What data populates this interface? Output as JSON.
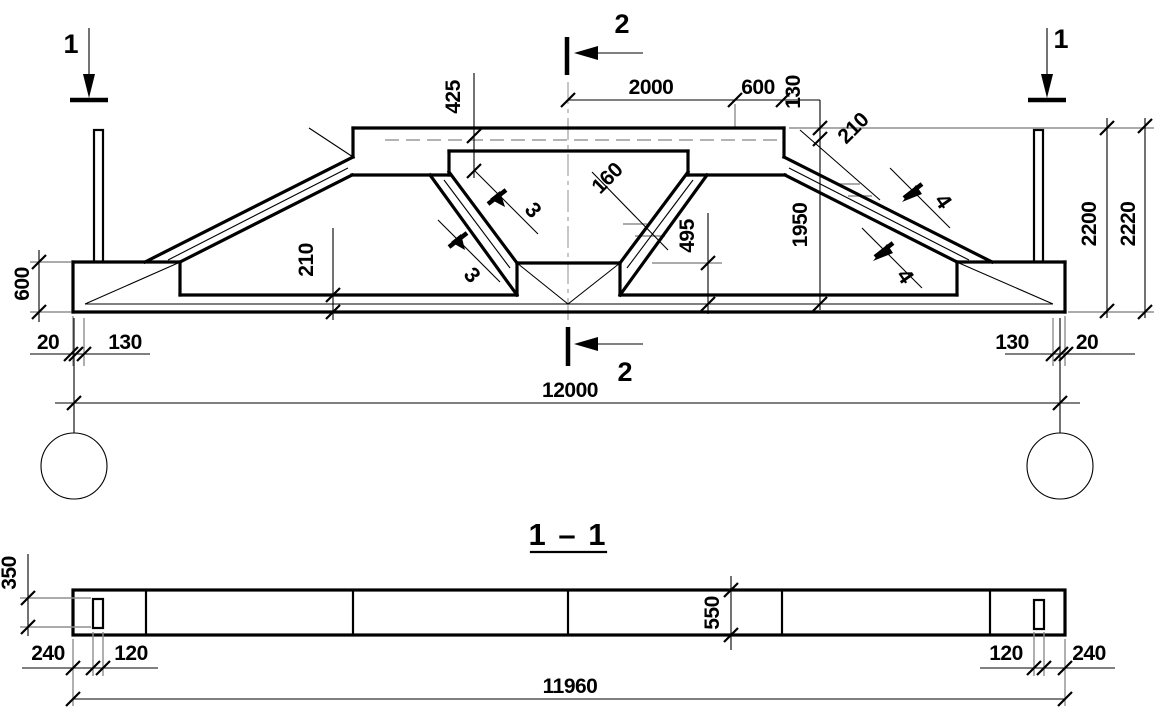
{
  "colors": {
    "ink": "#000000",
    "extension_gray": "#8f8f8f",
    "background": "#ffffff"
  },
  "elevation": {
    "marks": {
      "cut1_left": "1",
      "cut1_right": "1",
      "cut2_top": "2",
      "cut2_bottom": "2",
      "cut3_upper": "3",
      "cut3_lower": "3",
      "cut4_upper": "4",
      "cut4_lower": "4"
    },
    "dims": {
      "top_half_span": "2000",
      "top_offset": "600",
      "flange_edge_drop": "130",
      "flange_ledge_drop": "425",
      "web_thickness": "160",
      "slope_thickness": "210",
      "bottom_chord_depth": "210",
      "web_node_drop": "495",
      "slope_rise": "1950",
      "height_to_top": "2200",
      "overall_height": "2220",
      "support_block_depth": "600",
      "left_overhang": "20",
      "left_edge_inset": "130",
      "right_edge_inset": "130",
      "right_overhang": "20",
      "span": "12000"
    }
  },
  "section": {
    "title": "1 – 1",
    "dims": {
      "plate_length": "350",
      "left_end_offset": "240",
      "left_plate_width": "120",
      "beam_depth": "550",
      "right_plate_width": "120",
      "right_end_offset": "240",
      "beam_length": "11960"
    }
  }
}
